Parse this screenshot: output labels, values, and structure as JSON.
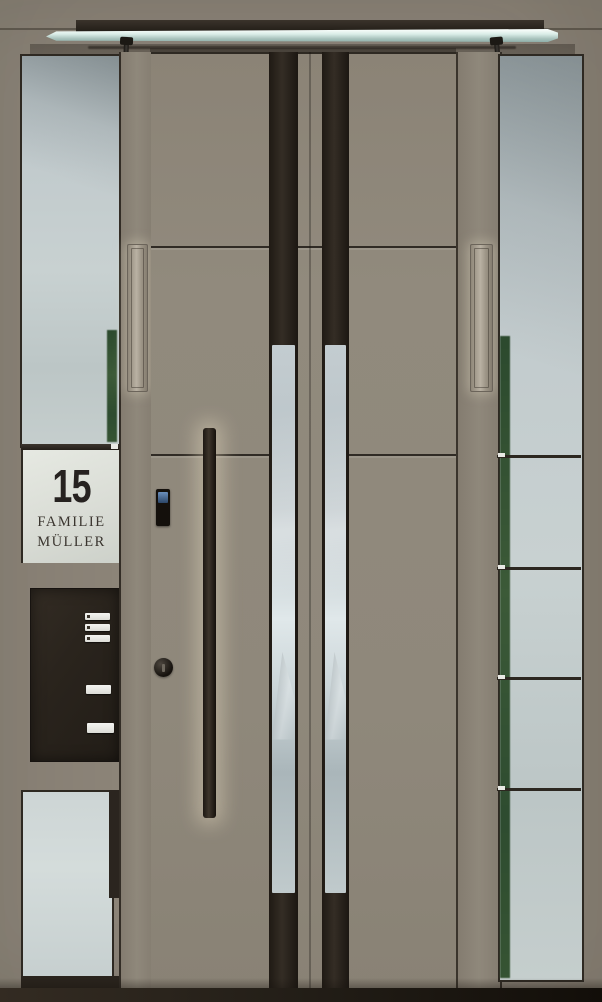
{
  "sign": {
    "house_number": "15",
    "family_line1": "FAMILIE",
    "family_line2": "MÜLLER"
  },
  "mailbox": {
    "intercom_button_count": 3,
    "nameplate_count": 1,
    "mail_slot_count": 1
  },
  "components": {
    "canopy": "glass-canopy",
    "canopy_supports": "steel-struts",
    "door_type": "double-leaf-entrance-door",
    "handle": "vertical-bar-handle-with-led",
    "access": "fingerprint-keypad",
    "lock": "cylinder-lock",
    "side_panels": "glass-sidelights"
  },
  "colors": {
    "wall": "#8c8478",
    "door": "#8f887b",
    "stripe": "#2a241d",
    "glass": "#c2cbce",
    "sign_bg": "#dfe2dc",
    "sign_text": "#2b2723",
    "mailbox": "#2b241d",
    "floor": "#241f18",
    "canopy_glass": "#d9ece7",
    "handle_glow": "#eee2c6",
    "keypad_screen": "#4a6f9e",
    "reflection_green": "#3a5535"
  }
}
